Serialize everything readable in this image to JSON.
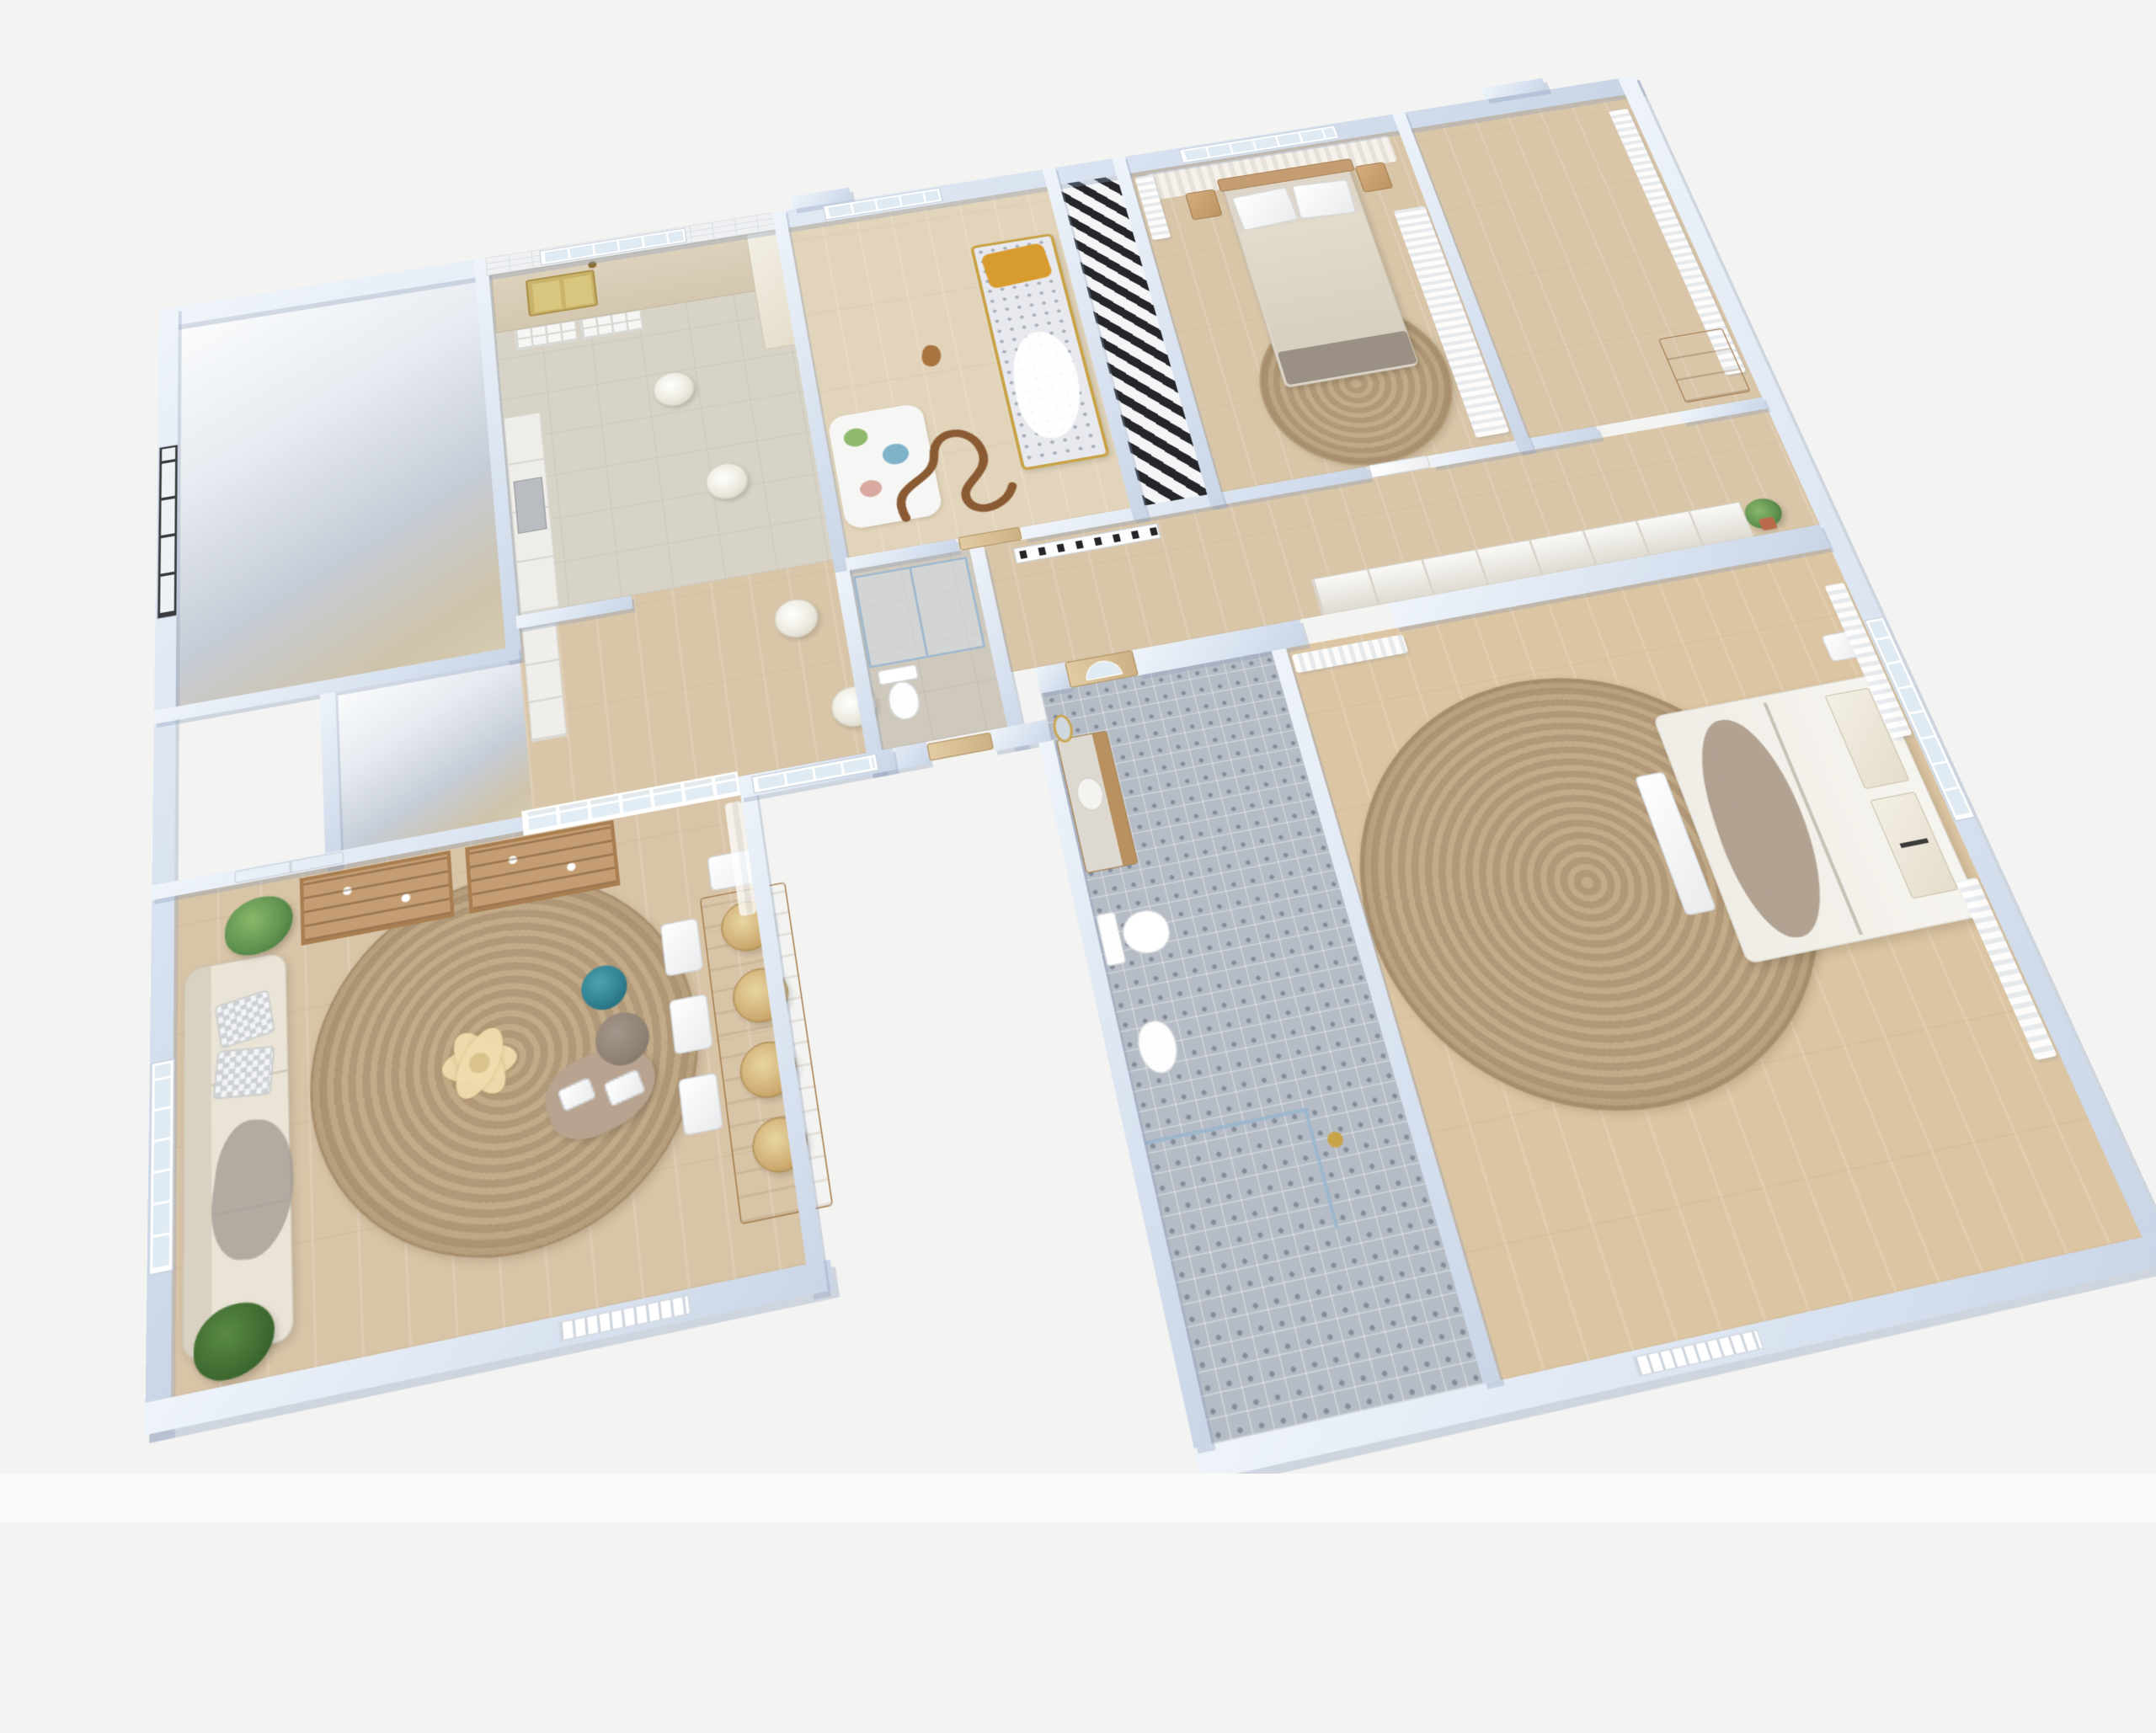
{
  "scene": {
    "title": "3D floor plan render of a furnished apartment, bird's-eye axonometric view",
    "background": "#f3f3f1",
    "view": {
      "type": "axonometric-birds-eye",
      "rotation_deg": -11.5,
      "tilt_deg": 24
    }
  },
  "palette": {
    "bg": "#f3f3f1",
    "bg-strip": "#fafaf8",
    "wall-light": "#eff4fa",
    "wall-mid": "#dbe4f1",
    "wall-dark": "#c9d5e6",
    "wall-shadow": "rgba(140,158,185,0.35)",
    "wood": "#d9c6a9",
    "wood-light": "#e2d4ba",
    "stone": "#d8d3c7",
    "tile": "#b6bcc6",
    "jute": "#c2ab88",
    "jute-dark": "#b19878",
    "sofa": "#eae4d6",
    "teal": "#2e7e8f",
    "taupe": "#8d8072",
    "mustard": "#d89b2e",
    "gold": "#c9a347",
    "wood-furn": "#c59d72",
    "wood-dark": "#a97f52",
    "glass": "#dfeaf2",
    "plant": "#5d8f4e",
    "plant-dark": "#3c6630",
    "dark": "#24262a",
    "gray-bed": "#9a9184",
    "cream": "#efe9db"
  },
  "rooms": [
    {
      "id": "empty-room",
      "name": "Unfurnished room",
      "floor": "wood",
      "features": [
        "dark-frame window"
      ]
    },
    {
      "id": "small-empty-room",
      "name": "Small unfurnished room",
      "floor": "wood",
      "features": []
    },
    {
      "id": "kitchen",
      "name": "Kitchen",
      "floor": "stone",
      "features": [
        "subway-tile wall",
        "window",
        "counter with brass double sink",
        "glass-front base cabinets",
        "tall cream cabinet",
        "cabinet run with appliance",
        "2 pendant lights"
      ]
    },
    {
      "id": "hall",
      "name": "Hall passage",
      "floor": "wood",
      "features": [
        "glazed partition to living room",
        "interior grid window",
        "2 pendant lights",
        "cabinet run"
      ]
    },
    {
      "id": "shower-room",
      "name": "Shower room",
      "floor": "stone",
      "features": [
        "glass shower enclosure",
        "toilet",
        "gold mirror",
        "door"
      ]
    },
    {
      "id": "nursery",
      "name": "Nursery",
      "floor": "wood",
      "features": [
        "window",
        "gold-frame crib with mustard pillow and gray bedding",
        "play mat",
        "wooden toy track",
        "toy horse",
        "door to corridor"
      ]
    },
    {
      "id": "striped-nook",
      "name": "Black-and-white striped nook",
      "floor": "stripes",
      "features": []
    },
    {
      "id": "bedroom",
      "name": "Bedroom",
      "floor": "wood",
      "features": [
        "window with sheer curtains",
        "double bed with wood headboard",
        "2 wood nightstands",
        "round jute rug",
        "curtain-front wardrobe",
        "door to corridor"
      ]
    },
    {
      "id": "closet-corridor",
      "name": "Walk-through closet",
      "floor": "wood",
      "features": [
        "full-height curtain",
        "wood dresser"
      ]
    },
    {
      "id": "corridor",
      "name": "Corridor",
      "floor": "wood",
      "features": [
        "paneled wardrobe wall",
        "radiator",
        "hanging plant",
        "opening to master bedroom"
      ]
    },
    {
      "id": "living-room",
      "name": "Living and dining room",
      "floor": "wood",
      "features": [
        "white double door",
        "2 ladder bookshelves",
        "beige sofa with check cushions and gray throw",
        "2 potted plants",
        "round jute rug",
        "flower-shaped coffee table",
        "wavy side table with books",
        "teal pouf",
        "taupe pouf",
        "wood dining table",
        "3 white chairs",
        "head chair",
        "bench",
        "4 rattan pendant lamps",
        "window",
        "sheer curtain",
        "exterior vent grille"
      ]
    },
    {
      "id": "bathroom",
      "name": "Bathroom",
      "floor": "patterned-tile",
      "features": [
        "arched glazed door",
        "wood vanity with marble top",
        "gold oval mirror",
        "toilet",
        "bidet",
        "glass shower screen",
        "gold floor lamp"
      ]
    },
    {
      "id": "master-bedroom",
      "name": "Master bedroom",
      "floor": "wood",
      "features": [
        "french window",
        "sheer curtains",
        "double bed with cream bedding and taupe gauze throw",
        "white bench",
        "nightstand",
        "large round jute rug",
        "exterior vent grille"
      ]
    }
  ]
}
